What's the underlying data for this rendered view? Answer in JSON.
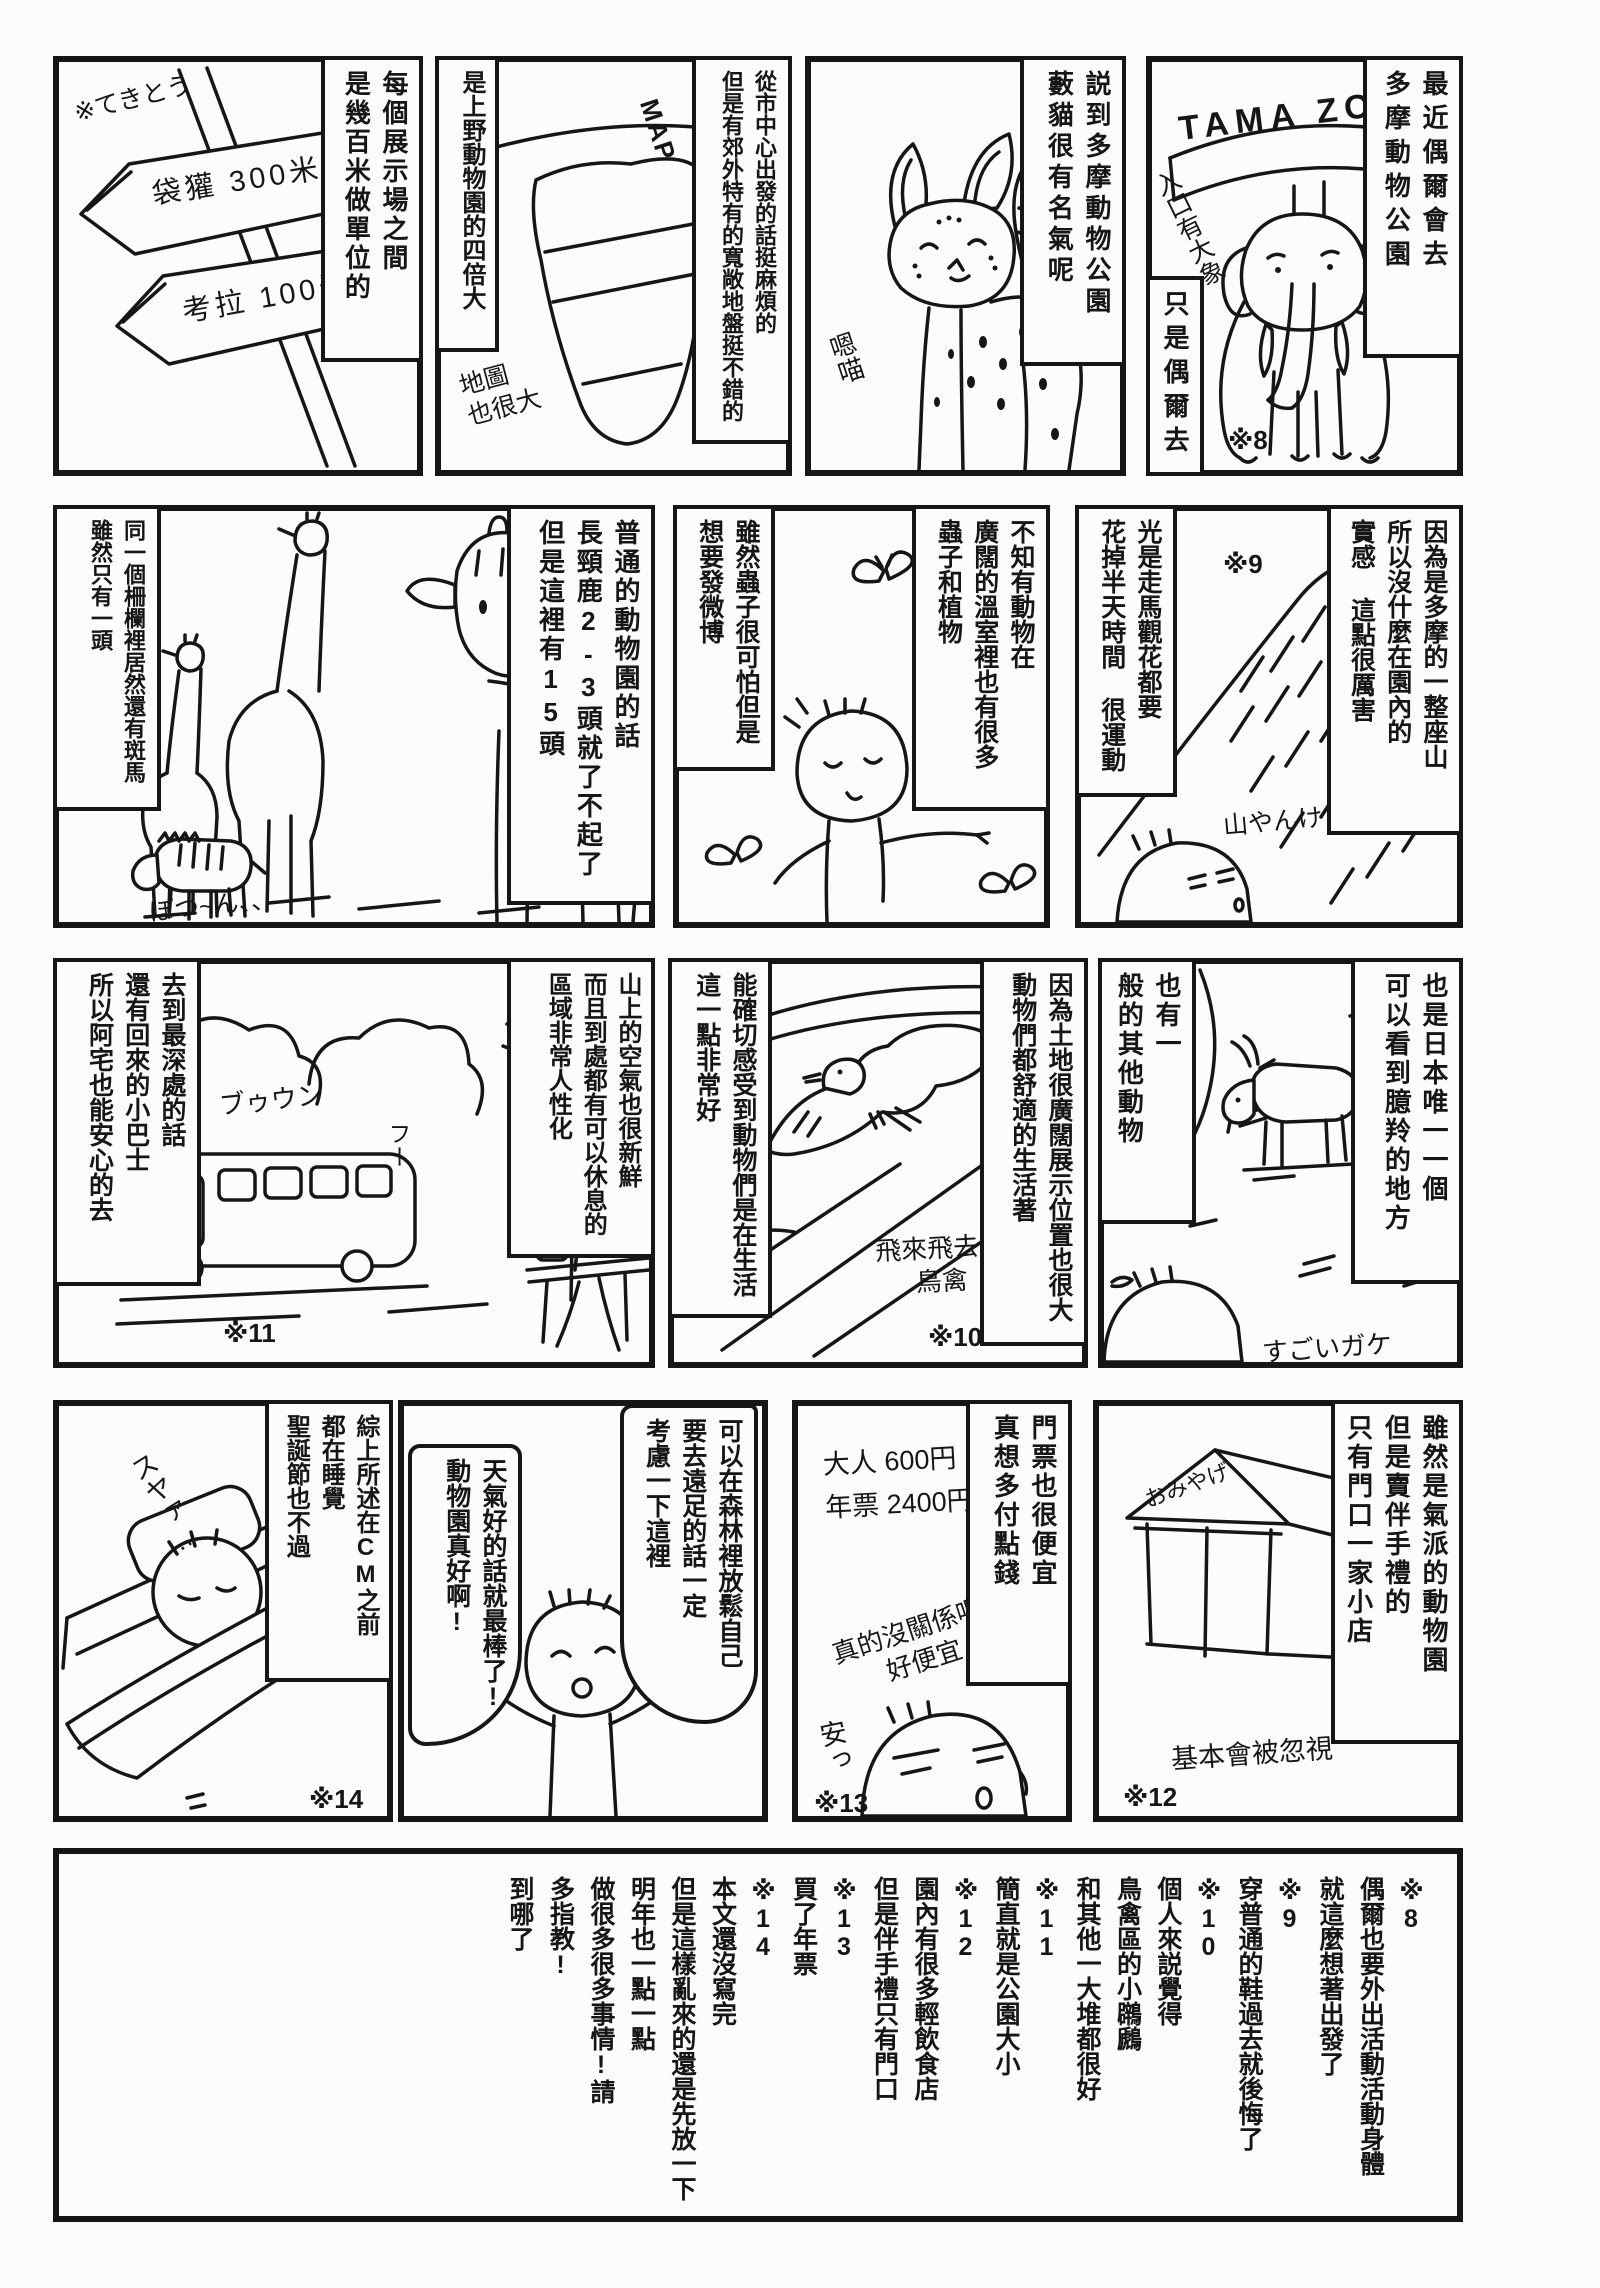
{
  "colors": {
    "ink": "#161616",
    "paper": "#fcfcfb"
  },
  "panels": {
    "tamazoo": {
      "caption_right": "最近偶爾會去\n多摩動物公園",
      "sign": "TAMA ZOO",
      "note_entrance": "入口有大象",
      "caption_sometimes": "只是偶爾去",
      "footnote_mark": "※8"
    },
    "serval": {
      "caption": "説到多摩動物公園\n藪貓很有名氣呢",
      "meow": "嗯喵"
    },
    "map": {
      "caption_access": "從市中心出發的話挺麻煩的\n但是有郊外特有的寬敞地盤挺不錯的",
      "caption_size": "是上野動物園的四倍大",
      "map_label": "MAP",
      "note_big_map": "地圖\n也很大"
    },
    "signs": {
      "note_rough": "※てきとう",
      "sign_devil": "袋獾 300米",
      "sign_koala": "考拉 100米",
      "caption": "每個展示場之間\n是幾百米做單位的"
    },
    "mountain": {
      "caption_right": "因為是多摩的一整座山\n所以沒什麼在園內的\n實感 這點很厲害",
      "footnote_mark": "※9",
      "caption_left": "光是走馬觀花都要\n花掉半天時間 很運動",
      "note_mountain": "山やんけ"
    },
    "greenhouse": {
      "caption_right": "不知有動物在\n廣闊的溫室裡也有很多\n蟲子和植物",
      "caption_left": "雖然蟲子很可怕但是\n想要發微博"
    },
    "giraffes": {
      "caption_right": "普通的動物園的話\n長頸鹿2-3頭就了不起了\n但是這裡有15頭",
      "caption_left": "同一個柵欄裡居然還有斑馬\n雖然只有一頭",
      "note_alone": "ぽつ~ん、、"
    },
    "serow": {
      "caption_right": "也是日本唯一一個\n可以看到臆羚的地方",
      "caption_left": "也有一\n般的其他動物",
      "note_cliff": "すごいガケ"
    },
    "birds": {
      "caption_right": "因為土地很廣闊展示位置也很大\n動物們都舒適的生活著",
      "caption_left": "能確切感受到動物們是在生活\n這一點非常好",
      "note_birds": "飛來飛去的\n鳥禽",
      "footnote_mark": "※10"
    },
    "bus": {
      "caption_right": "山上的空氣也很新鮮\n而且到處都有可以休息的\n區域非常人性化",
      "caption_left": "去到最深處的話\n還有回來的小巴士\n所以阿宅也能安心的去",
      "sound_bus": "ブゥウン",
      "sigh": "フー",
      "footnote_mark": "※11"
    },
    "shop": {
      "caption_right": "雖然是氣派的動物園\n但是賣伴手禮的\n只有門口一家小店",
      "shop_sign": "おみやげ",
      "note_ignored": "基本會被忽視",
      "footnote_mark": "※12"
    },
    "ticket": {
      "caption_right": "門票也很便宜\n真想多付點錢",
      "prices": "大人 600円\n年票 2400円",
      "note_cheap_q": "真的沒關係嗎?\n好便宜",
      "note_cheap": "安っ",
      "footnote_mark": "※13"
    },
    "forest": {
      "bubble_right": "可以在森林裡放鬆自己\n要去遠足的話一定\n考慮一下這裡",
      "bubble_left": "天氣好的話就最棒了!\n動物園真好啊!"
    },
    "sleep": {
      "caption_right": "綜上所述在CM之前\n都在睡覺\n聖誕節也不過",
      "note_snore": "スヤァ…",
      "footnote_mark": "※14"
    }
  },
  "footnotes": {
    "text": "※8\n偶爾也要外出活動活動身體\n就這麼想著出發了\n※9\n穿普通的鞋過去就後悔了\n※10\n個人來説覺得\n鳥禽區的小鸊鷉\n和其他一大堆都很好\n※11\n簡直就是公園大小\n※12\n園內有很多輕飲食店\n但是伴手禮只有門口\n※13\n買了年票\n※14\n本文還沒寫完\n但是這樣亂來的還是先放一下\n明年也一點一點\n做很多很多事情!請\n多指教!\n到哪了"
  }
}
